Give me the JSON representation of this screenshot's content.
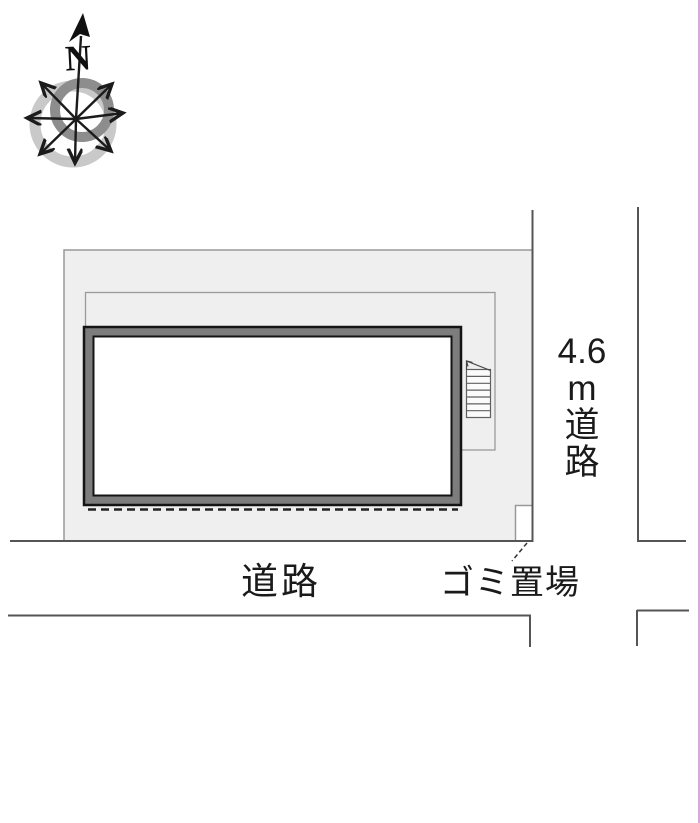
{
  "diagram": {
    "title": "site-plan",
    "compass": {
      "north": "N"
    },
    "roads": {
      "east_road_label": "4.6m道路",
      "east_road_label_lines": [
        "4.6",
        "m",
        "道",
        "路"
      ],
      "south_road_label": "道路"
    },
    "garbage": {
      "label": "ゴミ置場"
    },
    "colors": {
      "site_fill": "#efefef",
      "site_border": "#999999",
      "road_line": "#555555",
      "building_outline": "#141414",
      "building_band": "#7d7d7d",
      "dashed_line": "#222222",
      "compass_ring_light": "#c9c9c9",
      "compass_ring_dark": "#8d8d8d",
      "right_edge_artifact": "#d7a7d7"
    }
  }
}
